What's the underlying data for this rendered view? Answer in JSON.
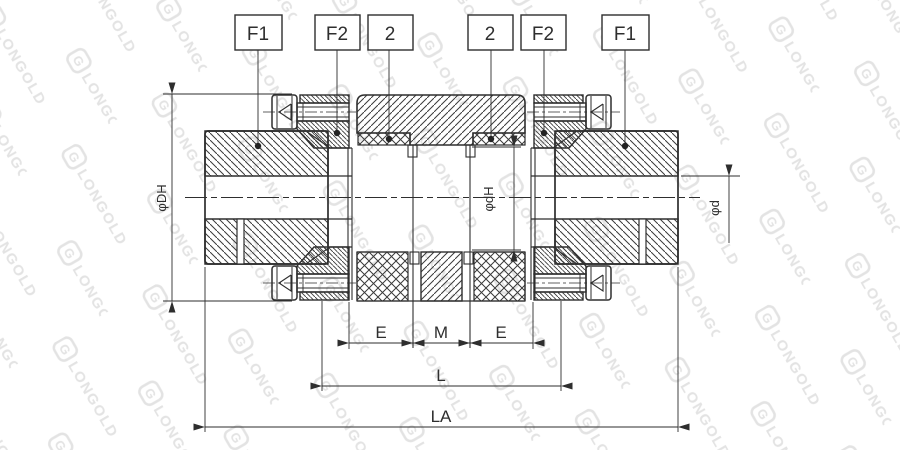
{
  "drawing": {
    "title": "flexible-jaw-coupling-section-drawing",
    "part_labels": {
      "f1_left": "F1",
      "f2_left": "F2",
      "two_left": "2",
      "two_right": "2",
      "f2_right": "F2",
      "f1_right": "F1"
    },
    "dimensions": {
      "outer_diameter": "φDH",
      "inner_diameter": "φdH",
      "bore_diameter": "φd",
      "e_left": "E",
      "m": "M",
      "e_right": "E",
      "l": "L",
      "la": "LA"
    },
    "watermark": {
      "text": "LONGOLD",
      "icon_glyph": "G"
    },
    "colors": {
      "line": "#2e2e2e",
      "hatch": "#3a3a3a",
      "watermark": "#e3e3e3",
      "background": "#ffffff"
    }
  }
}
